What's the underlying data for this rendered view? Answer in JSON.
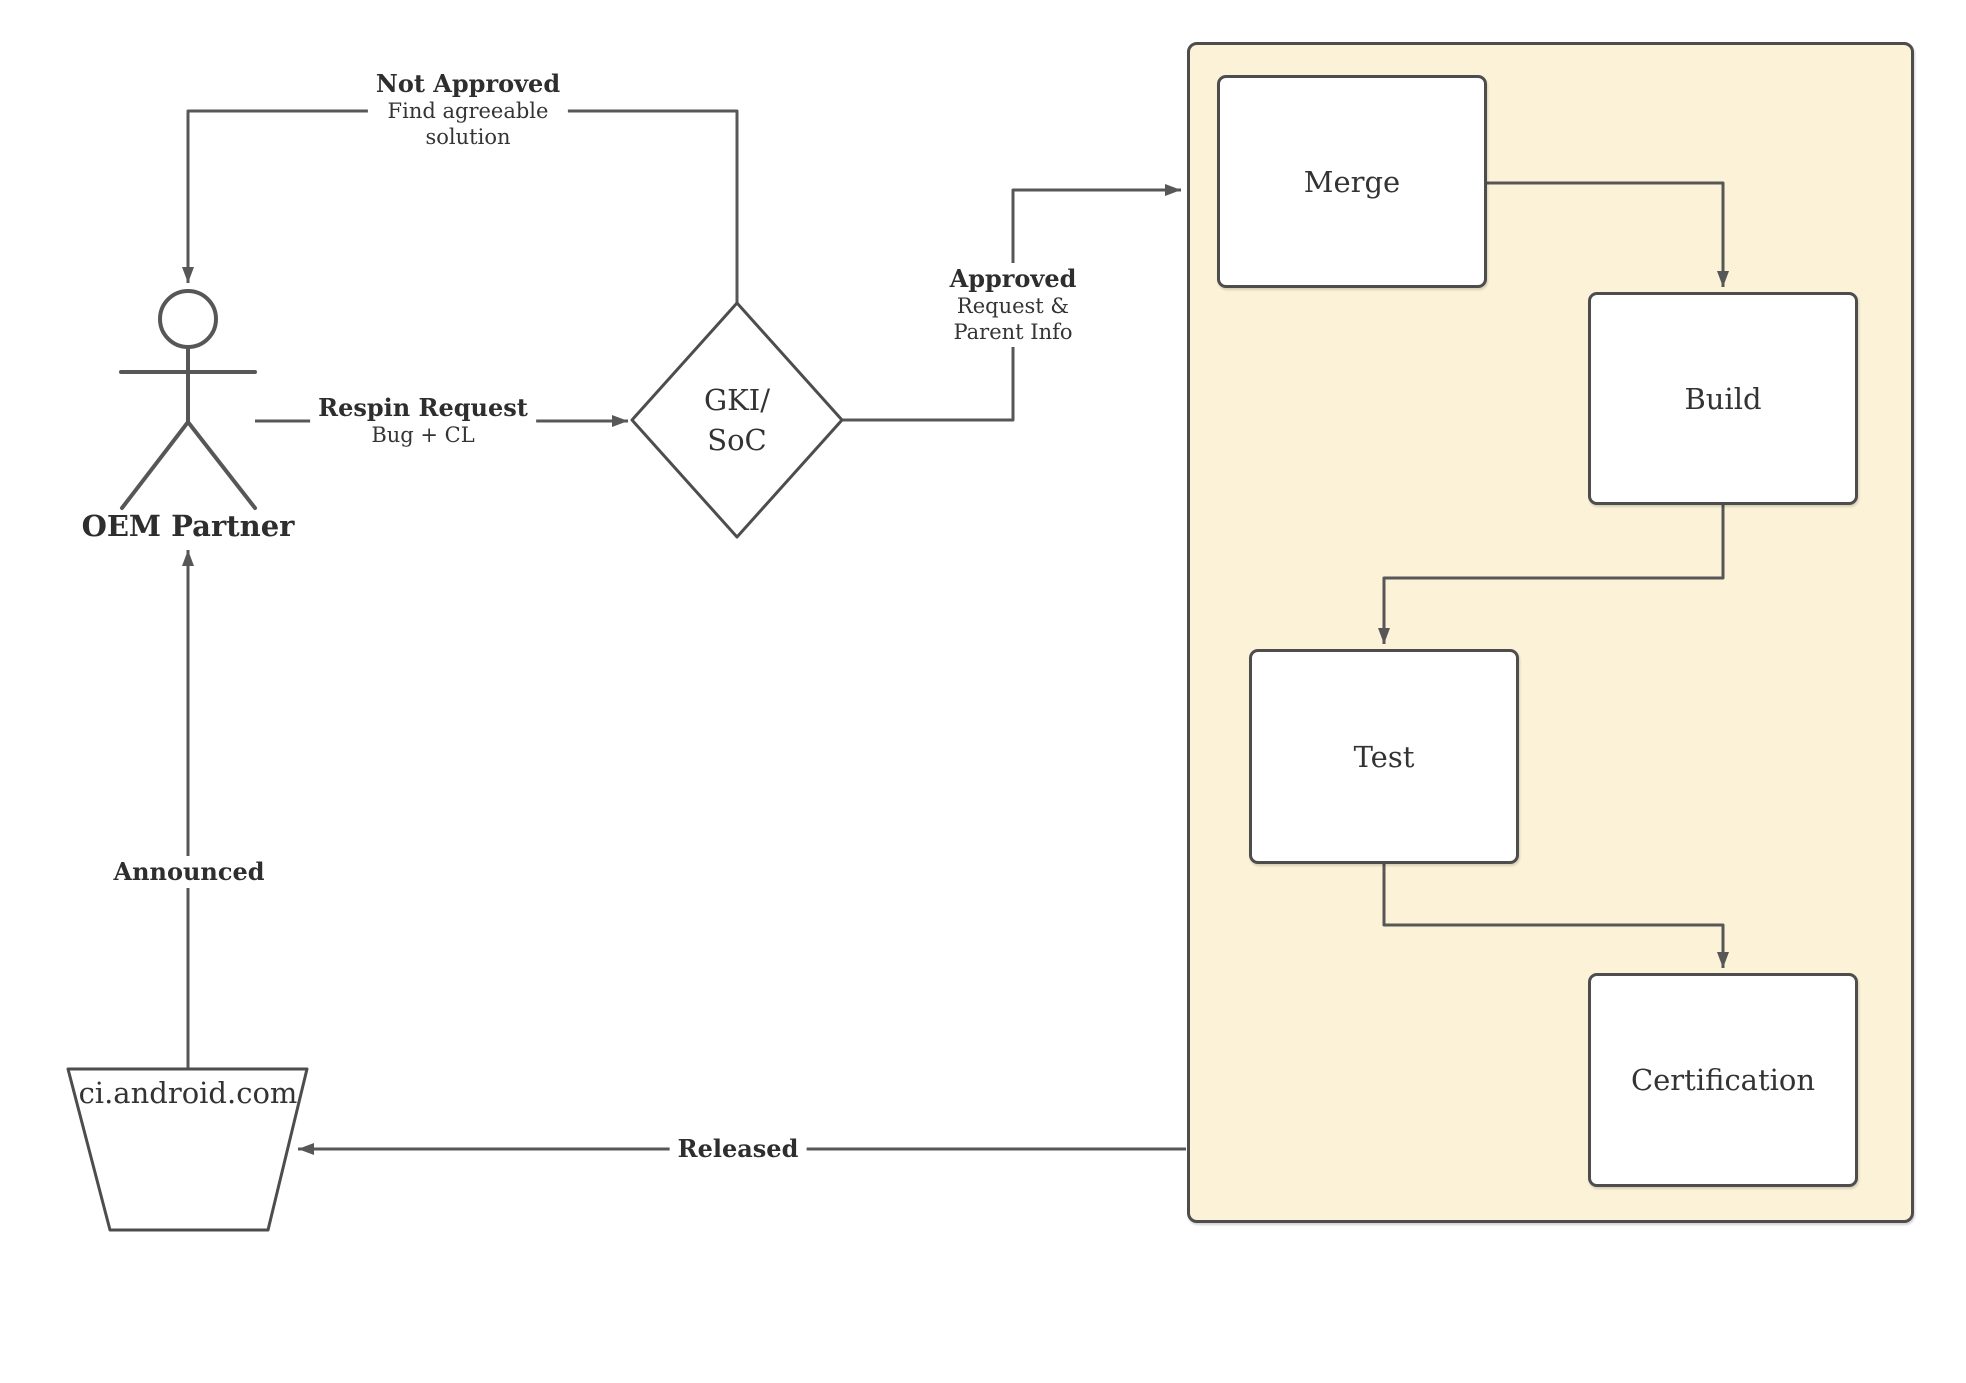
{
  "nodes": {
    "actor": {
      "label": "OEM Partner"
    },
    "decision": {
      "line1": "GKI/",
      "line2": "SoC"
    },
    "merge": {
      "label": "Merge"
    },
    "build": {
      "label": "Build"
    },
    "test": {
      "label": "Test"
    },
    "certification": {
      "label": "Certification"
    },
    "ci": {
      "label": "ci.android.com"
    }
  },
  "edges": {
    "respin": {
      "title": "Respin Request",
      "subtitle": "Bug + CL"
    },
    "not_approved": {
      "title": "Not Approved",
      "subtitle": "Find agreeable solution"
    },
    "approved": {
      "title": "Approved",
      "subtitle": "Request & Parent Info"
    },
    "announced": {
      "title": "Announced"
    },
    "released": {
      "title": "Released"
    }
  },
  "colors": {
    "container_fill": "#fcf2d8",
    "shape_border": "#4d4d4d",
    "connector": "#575757",
    "node_fill": "#ffffff",
    "text": "#343434"
  }
}
